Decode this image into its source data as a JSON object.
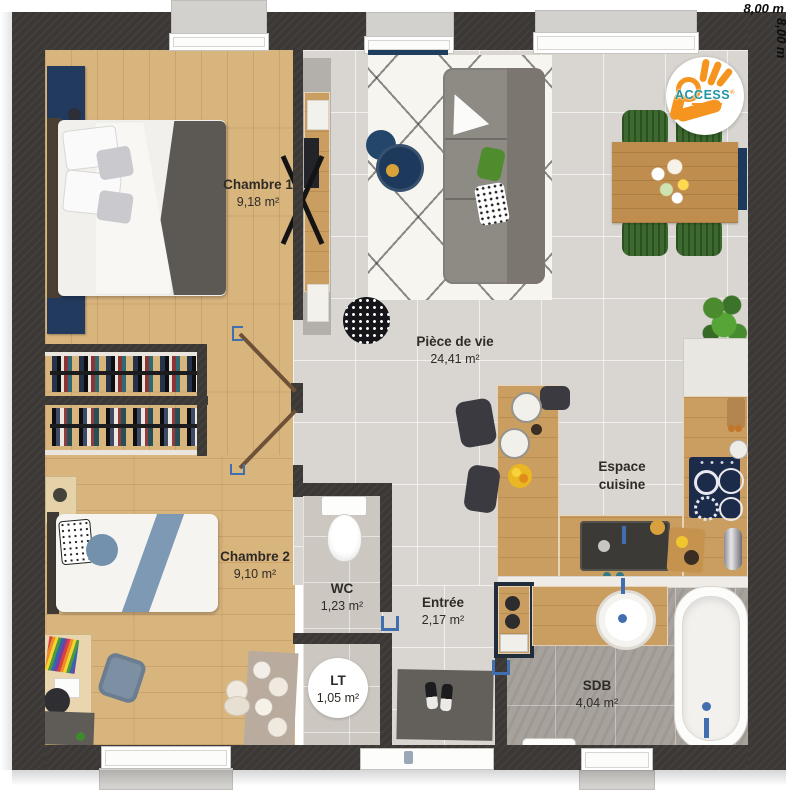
{
  "dimensions": {
    "top": "8,00 m",
    "right": "8,00 m"
  },
  "logo": {
    "brand": "ACCESS",
    "reg": "®"
  },
  "rooms": {
    "chambre1": {
      "name": "Chambre 1",
      "area": "9,18 m²"
    },
    "chambre2": {
      "name": "Chambre 2",
      "area": "9,10 m²"
    },
    "piece_de_vie": {
      "name": "Pièce de vie",
      "area": "24,41 m²"
    },
    "espace_cuisine": {
      "name": "Espace cuisine"
    },
    "wc": {
      "name": "WC",
      "area": "1,23 m²"
    },
    "entree": {
      "name": "Entrée",
      "area": "2,17 m²"
    },
    "lt": {
      "name": "LT",
      "area": "1,05 m²"
    },
    "sdb": {
      "name": "SDB",
      "area": "4,04 m²"
    }
  },
  "colors": {
    "wall": "#3b3836",
    "wood_floor": "#d9b57e",
    "kitchen_wood": "#c99e60",
    "tile_light": "#d9d6d1",
    "tile_dark": "#a7a29b",
    "accent_navy": "#1e3a5c",
    "door_blue": "#3f6fae",
    "chair_green": "#3c6a2e",
    "brand_orange": "#f5941f",
    "brand_teal": "#2096a5"
  }
}
